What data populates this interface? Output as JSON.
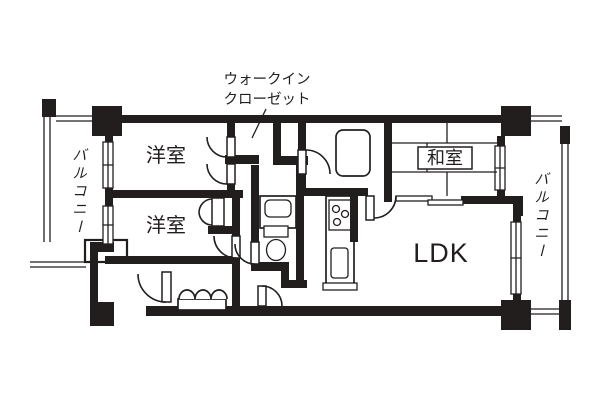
{
  "diagram_title": "apartment floor plan",
  "colors": {
    "wall": "#221e1e",
    "background": "#ffffff"
  },
  "labels": {
    "walk_in_closet_line1": "ウォークイン",
    "walk_in_closet_line2": "クローゼット",
    "room_western_1": "洋室",
    "room_western_2": "洋室",
    "room_japanese": "和室",
    "ldk": "LDK",
    "balcony_left": "バルコニー",
    "balcony_right": "バルコニー"
  }
}
